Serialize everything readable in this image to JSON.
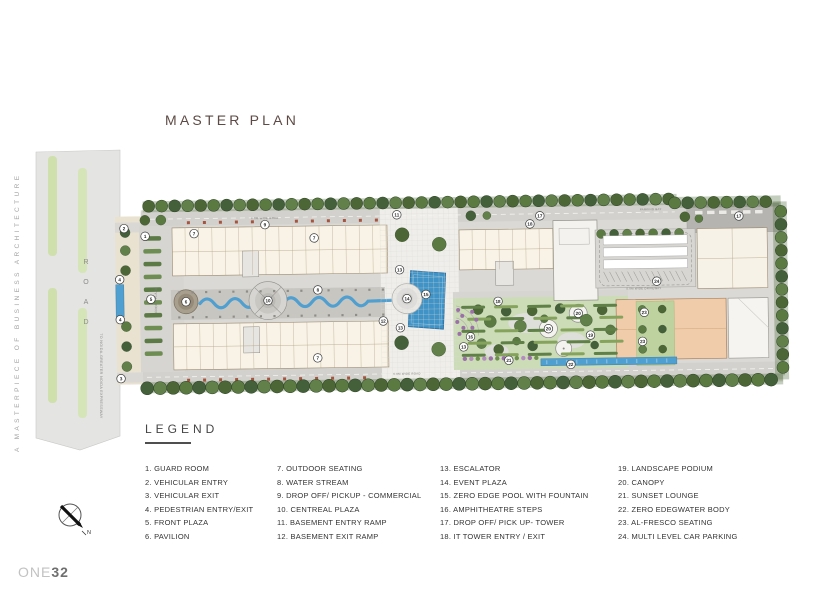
{
  "header": {
    "title": "MASTER PLAN"
  },
  "side_text": "A MASTERPIECE OF BUSINESS ARCHITECTURE",
  "logo": {
    "prefix": "ONE",
    "suffix": "32"
  },
  "compass": {
    "label": "N"
  },
  "road": {
    "label": "ROAD",
    "direction": "TO NOIDA-GREATER NOIDA EXPRESSWAY"
  },
  "plan": {
    "labels": [
      {
        "text": "FRONT PLAZA",
        "x": 41,
        "y": 104,
        "rot": -90,
        "size": 3.2
      },
      {
        "text": "6.0M WIDE ROAD",
        "x": 150,
        "y": 24.5,
        "rot": 0,
        "size": 2.8
      },
      {
        "text": "6.0M WIDE ROAD",
        "x": 290,
        "y": 182,
        "rot": 0,
        "size": 2.8
      },
      {
        "text": "PARKING BAY",
        "x": 536,
        "y": 21,
        "rot": 0,
        "size": 2.8
      },
      {
        "text": "5.0M WIDE DRIVEWAY",
        "x": 528,
        "y": 100,
        "rot": 0,
        "size": 2.8
      }
    ],
    "badges": [
      {
        "n": "1",
        "x": 30,
        "y": 40
      },
      {
        "n": "2",
        "x": 9,
        "y": 32
      },
      {
        "n": "4",
        "x": 4,
        "y": 83
      },
      {
        "n": "4",
        "x": 4,
        "y": 123
      },
      {
        "n": "3",
        "x": 4,
        "y": 182
      },
      {
        "n": "5",
        "x": 35,
        "y": 103
      },
      {
        "n": "6",
        "x": 70,
        "y": 106
      },
      {
        "n": "7",
        "x": 79,
        "y": 38
      },
      {
        "n": "7",
        "x": 199,
        "y": 44
      },
      {
        "n": "7",
        "x": 201,
        "y": 164
      },
      {
        "n": "8",
        "x": 202,
        "y": 96
      },
      {
        "n": "9",
        "x": 150,
        "y": 30
      },
      {
        "n": "10",
        "x": 152,
        "y": 106
      },
      {
        "n": "11",
        "x": 282,
        "y": 22
      },
      {
        "n": "12",
        "x": 267,
        "y": 128
      },
      {
        "n": "13",
        "x": 284,
        "y": 77
      },
      {
        "n": "13",
        "x": 284,
        "y": 135
      },
      {
        "n": "13",
        "x": 347,
        "y": 155
      },
      {
        "n": "14",
        "x": 291,
        "y": 106
      },
      {
        "n": "15",
        "x": 310,
        "y": 102
      },
      {
        "n": "16",
        "x": 354,
        "y": 145
      },
      {
        "n": "17",
        "x": 425,
        "y": 25
      },
      {
        "n": "17",
        "x": 624,
        "y": 28
      },
      {
        "n": "18",
        "x": 415,
        "y": 33
      },
      {
        "n": "18",
        "x": 382,
        "y": 110
      },
      {
        "n": "19",
        "x": 474,
        "y": 145
      },
      {
        "n": "20",
        "x": 432,
        "y": 138
      },
      {
        "n": "20",
        "x": 462,
        "y": 123
      },
      {
        "n": "21",
        "x": 392,
        "y": 169
      },
      {
        "n": "22",
        "x": 454,
        "y": 174
      },
      {
        "n": "23",
        "x": 528,
        "y": 123
      },
      {
        "n": "23",
        "x": 526,
        "y": 152
      },
      {
        "n": "24",
        "x": 541,
        "y": 92
      }
    ]
  },
  "legend": {
    "heading": "LEGEND",
    "columns": [
      [
        {
          "num": "1",
          "label": "GUARD ROOM"
        },
        {
          "num": "2",
          "label": "VEHICULAR ENTRY"
        },
        {
          "num": "3",
          "label": "VEHICULAR EXIT"
        },
        {
          "num": "4",
          "label": "PEDESTRIAN ENTRY/EXIT"
        },
        {
          "num": "5",
          "label": "FRONT PLAZA"
        },
        {
          "num": "6",
          "label": "PAVILION"
        }
      ],
      [
        {
          "num": "7",
          "label": "OUTDOOR SEATING"
        },
        {
          "num": "8",
          "label": "WATER STREAM"
        },
        {
          "num": "9",
          "label": "DROP OFF/ PICKUP - COMMERCIAL"
        },
        {
          "num": "10",
          "label": "CENTREAL PLAZA"
        },
        {
          "num": "11",
          "label": "BASEMENT ENTRY RAMP"
        },
        {
          "num": "12",
          "label": "BASEMENT EXIT RAMP"
        }
      ],
      [
        {
          "num": "13",
          "label": "ESCALATOR"
        },
        {
          "num": "14",
          "label": "EVENT PLAZA"
        },
        {
          "num": "15",
          "label": "ZERO EDGE POOL WITH FOUNTAIN"
        },
        {
          "num": "16",
          "label": "AMPHITHEATRE STEPS"
        },
        {
          "num": "17",
          "label": "DROP OFF/ PICK UP- TOWER"
        },
        {
          "num": "18",
          "label": "IT TOWER ENTRY / EXIT"
        }
      ],
      [
        {
          "num": "19",
          "label": "LANDSCAPE PODIUM"
        },
        {
          "num": "20",
          "label": "CANOPY"
        },
        {
          "num": "21",
          "label": "SUNSET LOUNGE"
        },
        {
          "num": "22",
          "label": "ZERO EDEGWATER BODY"
        },
        {
          "num": "23",
          "label": "AL-FRESCO SEATING"
        },
        {
          "num": "24",
          "label": "MULTI LEVEL CAR PARKING"
        }
      ]
    ]
  },
  "colors": {
    "water": "#4f9fd0",
    "pool": "#3f93c6",
    "building_cream": "#f8f3e6",
    "building_peach": "#f1ccab",
    "road_gray": "#e4e4e2",
    "tree_dark": "#4c6636",
    "podium_green": "#cbdcb7",
    "accent_purple": "#9b6fa8"
  }
}
